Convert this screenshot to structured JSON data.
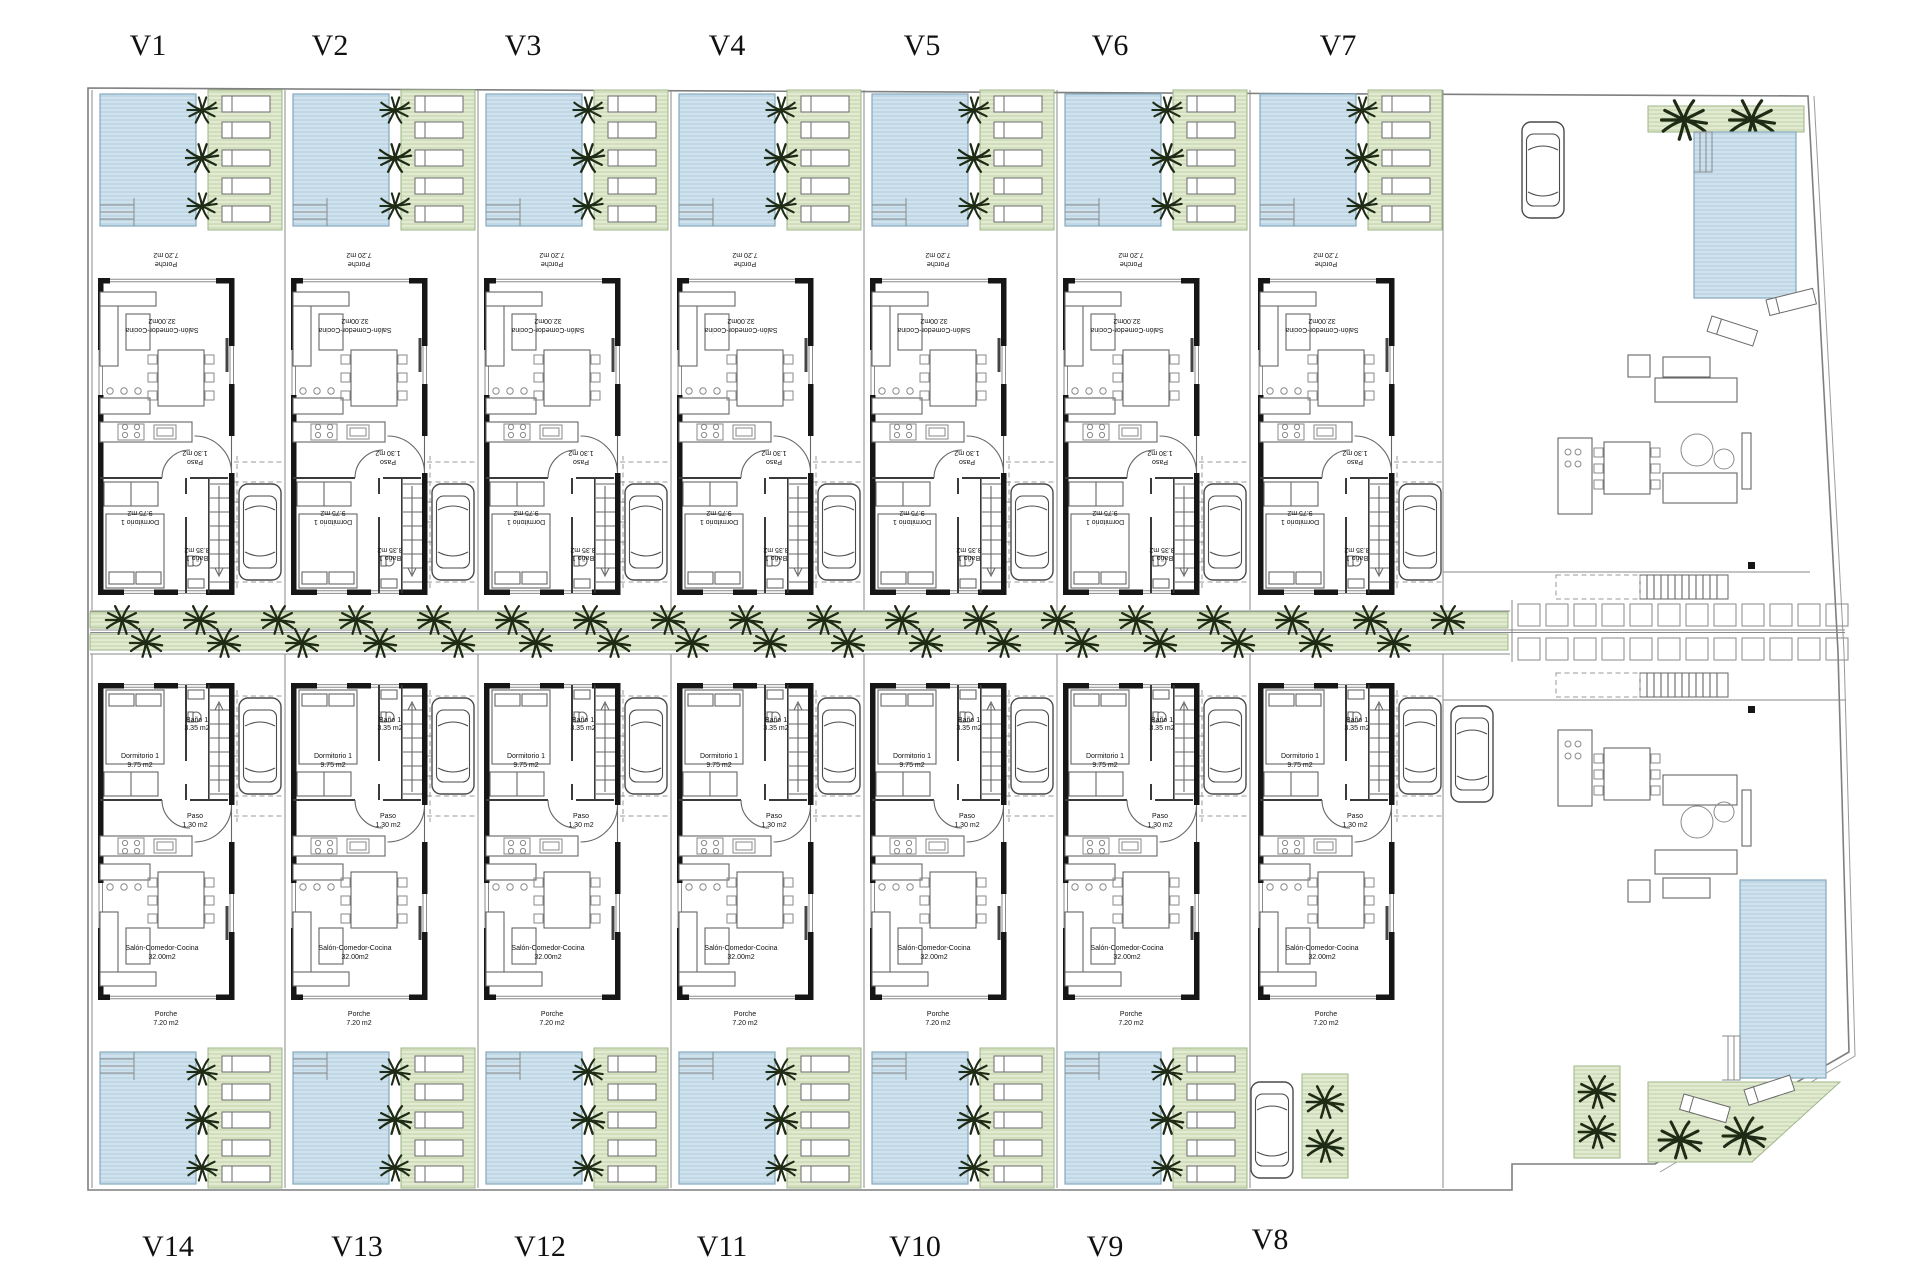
{
  "page": {
    "background": "#ffffff",
    "type_label": "residential site floor plan"
  },
  "labels": {
    "top": [
      {
        "text": "V1",
        "x": 148
      },
      {
        "text": "V2",
        "x": 330
      },
      {
        "text": "V3",
        "x": 523
      },
      {
        "text": "V4",
        "x": 727
      },
      {
        "text": "V5",
        "x": 922
      },
      {
        "text": "V6",
        "x": 1110
      },
      {
        "text": "V7",
        "x": 1338
      }
    ],
    "bottom": [
      {
        "text": "V14",
        "x": 168
      },
      {
        "text": "V13",
        "x": 357
      },
      {
        "text": "V12",
        "x": 540
      },
      {
        "text": "V11",
        "x": 722
      },
      {
        "text": "V10",
        "x": 915
      },
      {
        "text": "V9",
        "x": 1105
      },
      {
        "text": "V8",
        "x": 1270
      }
    ]
  },
  "rooms": {
    "dormitorio": {
      "name": "Dormitorio 1",
      "area": "9.75 m2"
    },
    "bano": {
      "name": "Baño 1",
      "area": "3.35 m2"
    },
    "paso": {
      "name": "Paso",
      "area": "1.30 m2"
    },
    "salon": {
      "name": "Salón-Comedor-Cocina",
      "area": "32.00m2"
    },
    "porche": {
      "name": "Porche",
      "area": "7.20 m2"
    }
  },
  "villas": {
    "top": [
      {
        "id": "v1",
        "x": 92
      },
      {
        "id": "v2",
        "x": 285
      },
      {
        "id": "v3",
        "x": 478
      },
      {
        "id": "v4",
        "x": 671
      },
      {
        "id": "v5",
        "x": 864
      },
      {
        "id": "v6",
        "x": 1057
      },
      {
        "id": "v7",
        "x": 1252
      }
    ],
    "bottom": [
      {
        "id": "v14",
        "x": 92
      },
      {
        "id": "v13",
        "x": 285
      },
      {
        "id": "v12",
        "x": 478
      },
      {
        "id": "v11",
        "x": 671
      },
      {
        "id": "v10",
        "x": 864
      },
      {
        "id": "v9",
        "x": 1057
      },
      {
        "id": "v8",
        "x": 1252,
        "no_yard": true
      }
    ]
  },
  "site": {
    "lot_width": 193,
    "lot_divider_x": [
      92,
      285,
      478,
      671,
      864,
      1057,
      1250,
      1443
    ],
    "street_trees_row1": {
      "y": 620,
      "x_start": 122,
      "step": 78,
      "count": 18
    },
    "street_trees_row2": {
      "y": 643,
      "x_start": 146,
      "step": 78,
      "count": 17
    },
    "tiles": {
      "rows_y": [
        604,
        638
      ],
      "x_start": 1518,
      "step": 28,
      "count": 12,
      "size": 22
    }
  },
  "colors": {
    "pool": "#cfe2ee",
    "pool_stripe": "#a9c8db",
    "pool_border": "#85a8bd",
    "garden": "#e2ebd1",
    "garden_stripe": "#b7cb9e",
    "garden_border": "#9fb588",
    "wall": "#161616",
    "line": "#666666",
    "thin": "#8a8a8a",
    "dash": "#999999",
    "tree": "#1e2b15",
    "text": "#111111"
  }
}
